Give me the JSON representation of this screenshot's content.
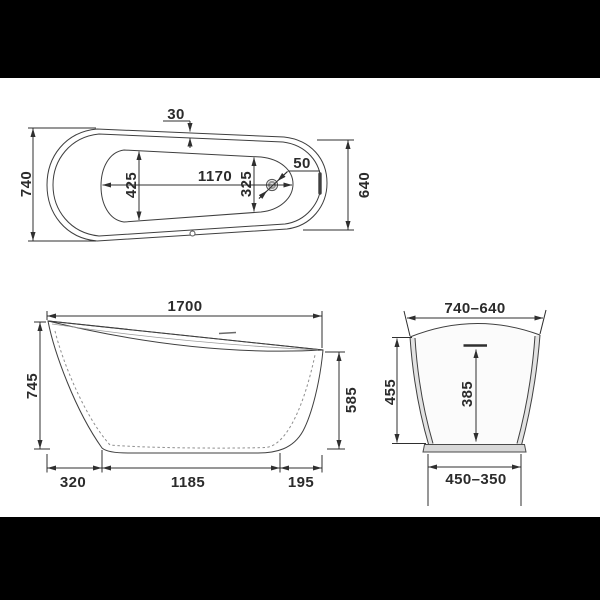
{
  "drawing": {
    "description": "Freestanding slipper bathtub technical dimension drawing with three orthographic views on white sheet, letterboxed on black",
    "views": {
      "top": {
        "labels": {
          "rim_width": "30",
          "width_left": "740",
          "basin_width": "425",
          "basin_length": "1170",
          "basin_width_at_drain": "325",
          "drain_diameter": "50",
          "width_right": "640"
        }
      },
      "side": {
        "labels": {
          "overall_length": "1700",
          "height_back": "745",
          "height_front": "585",
          "base_offset_back": "320",
          "base_length": "1185",
          "base_offset_front": "195"
        }
      },
      "end": {
        "labels": {
          "top_width_range": "740–640",
          "height": "455",
          "inner_depth": "385",
          "base_width_range": "450–350"
        }
      }
    },
    "colors": {
      "letterbox": "#000000",
      "paper": "#ffffff",
      "line": "#3f3f3f",
      "dim_text": "#2b2b2b",
      "body_fill": "#ececec",
      "wall_fill": "#e2e2e2",
      "base_fill": "#d8d8d8"
    }
  }
}
